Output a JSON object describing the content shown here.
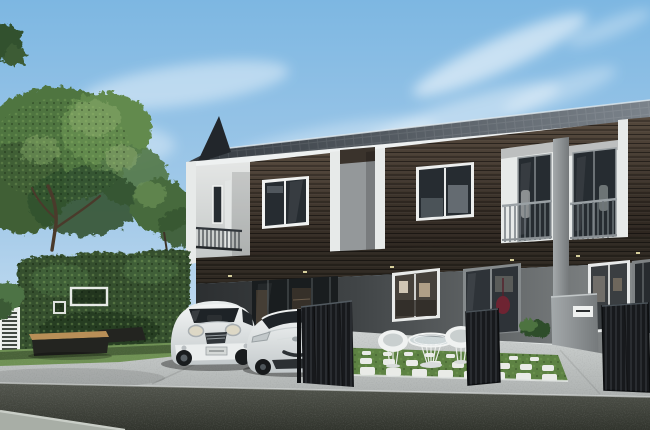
{
  "scene": {
    "title": "Architectural rendering of a modern two-storey townhouse row with parked white cars, hedge garden and patio furniture under a blue sky",
    "time_of_day": "daytime",
    "weather": "clear blue sky with wispy white clouds",
    "objects": [
      "blue sky with wispy clouds",
      "large leafy green tree on the left",
      "small tree behind garden hedge",
      "tall trimmed hedge wall with white rectangular signboard frames",
      "white garden lattice screen at far left",
      "dark bench with wooden top in front of hedge",
      "two-storey modern townhouse row with white frame trims",
      "dark shingled mono-pitch roof with triangular fin and white fascia",
      "dark wood-clad upper facade with white framed windows",
      "two recessed balconies with glass doors and metal railings",
      "small left balcony with dark railing",
      "grey party-wall slab between units",
      "ground floor with glass storefront, picture windows and entry doors",
      "maroon hanging chair visible through entry glass",
      "grey letterbox pillar with white mailbox slot",
      "dark metal entrance gates (folding and slatted panels)",
      "white MINI-style hatchback parked on driveway",
      "white sports coupe parked beside it",
      "white wire patio table with glass top and two white wire chairs",
      "front lawn with grid of white stepping pavers",
      "green shrubs at house base",
      "concrete driveway and sidewalk",
      "dark asphalt road with light kerb stripe in foreground"
    ],
    "colors": {
      "sky_top": "#7db7e2",
      "sky_mid": "#a9cdea",
      "sky_horizon": "#e0edf7",
      "cloud_white": "#ffffff",
      "roof_dark": "#343a40",
      "roof_light": "#7b838b",
      "roof_fin": "#22262b",
      "fascia_white": "#eef1f1",
      "trim_white": "#e7eae9",
      "wood_dark": "#2c251f",
      "wood_light": "#54483c",
      "wall_white_light": "#e4e6e5",
      "wall_white_shade": "#c3c7c6",
      "party_wall_gray": "#94989a",
      "band_dark": "#2f2922",
      "floor_wall_light": "#898d8e",
      "floor_wall_dark": "#404446",
      "glass_dark": "#262c31",
      "glass_frame_gray": "#858a8c",
      "rail_metal": "#9aa1a5",
      "rail_dark": "#31363b",
      "pillar_light": "#a4a9ab",
      "pillar_dark": "#75797b",
      "mailbox_white": "#eff1f0",
      "gate_dark": "#17191c",
      "hedge_green": "#34502f",
      "hedge_light": "#567947",
      "hedge_shadow": "#1c2c19",
      "tree_green": "#507441",
      "tree_light": "#83a566",
      "tree_dark": "#31512e",
      "trunk_brown": "#4a3a2b",
      "grass_green": "#6f9154",
      "lawn_green": "#5d8243",
      "paver_white": "#e9ebe7",
      "concrete_light": "#ced2d1",
      "concrete_dark": "#aeb2b1",
      "road_dark": "#31342d",
      "road_light": "#53564e",
      "curb_light": "#a8aea6",
      "car_white": "#f3f5f5",
      "car_shade": "#c2c8ca",
      "car_glass": "#1e2327",
      "bench_wood": "#b88f57",
      "bench_dark": "#232420",
      "chair_white": "#f0f2f1",
      "interior_warm": "#4a3e30",
      "hanging_chair_maroon": "#6e2432",
      "light_warm": "#e8e0a8"
    }
  }
}
